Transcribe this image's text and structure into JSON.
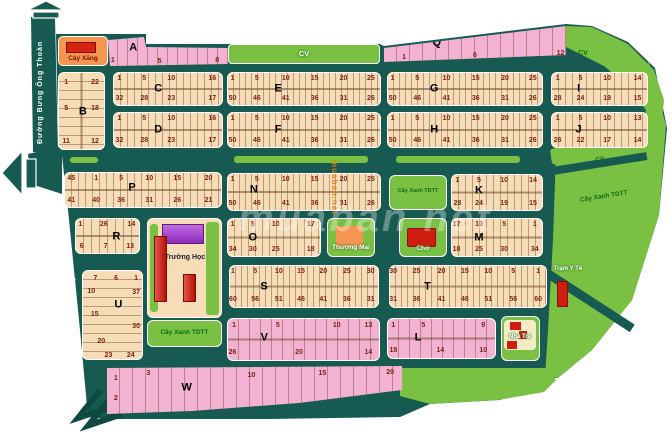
{
  "map_type": "land-plot subdivision map",
  "roads": {
    "name": "Đường Bưng Ông Thoàn"
  },
  "labels": {
    "park": "CV",
    "gas": "Cây Xăng",
    "school": "Trường Học",
    "commercial": "Thương Mại",
    "market": "Chợ",
    "health": "Trạm Y Tế",
    "kindergarten": "Nhà Trẻ",
    "green_tdtt": "Cây Xanh TDTT"
  },
  "watermark": {
    "main": "muaban net",
    "vertical": "muaban.net"
  },
  "colors": {
    "road": "#175a51",
    "cream_block": "#f7ddb7",
    "pink_block": "#f3b2d2",
    "green_area": "#7ac143",
    "gas_orange": "#f59550",
    "building_red": "#cf1d10",
    "building_purple": "#9a34c9",
    "number_text": "#7c1f12",
    "label_green_text": "#0e6b14"
  },
  "blocks": {
    "A": {
      "letter": "A",
      "bottom": [
        "1",
        "5",
        "8"
      ]
    },
    "B": {
      "letter": "B",
      "rows": [
        [
          "1",
          "22"
        ],
        [
          "5",
          "18"
        ],
        [
          "11",
          "12"
        ]
      ]
    },
    "C": {
      "letter": "C",
      "top": [
        "1",
        "5",
        "10",
        "16"
      ],
      "bottom": [
        "32",
        "28",
        "23",
        "17"
      ]
    },
    "D": {
      "letter": "D",
      "top": [
        "1",
        "5",
        "10",
        "16"
      ],
      "bottom": [
        "32",
        "28",
        "23",
        "17"
      ]
    },
    "E": {
      "letter": "E",
      "top": [
        "1",
        "5",
        "10",
        "15",
        "20",
        "25"
      ],
      "bottom": [
        "50",
        "46",
        "41",
        "36",
        "31",
        "26"
      ]
    },
    "F": {
      "letter": "F",
      "top": [
        "1",
        "5",
        "10",
        "15",
        "20",
        "25"
      ],
      "bottom": [
        "50",
        "46",
        "41",
        "36",
        "31",
        "26"
      ]
    },
    "G": {
      "letter": "G",
      "top": [
        "1",
        "5",
        "10",
        "15",
        "20",
        "25"
      ],
      "bottom": [
        "50",
        "46",
        "41",
        "36",
        "31",
        "26"
      ]
    },
    "H": {
      "letter": "H",
      "top": [
        "1",
        "5",
        "10",
        "15",
        "20",
        "25"
      ],
      "bottom": [
        "50",
        "46",
        "41",
        "36",
        "31",
        "26"
      ]
    },
    "I": {
      "letter": "I",
      "top": [
        "1",
        "5",
        "10",
        "14"
      ],
      "bottom": [
        "28",
        "24",
        "19",
        "15"
      ]
    },
    "J": {
      "letter": "J",
      "top": [
        "1",
        "5",
        "10",
        "13"
      ],
      "bottom": [
        "26",
        "22",
        "17",
        "14"
      ]
    },
    "K": {
      "letter": "K",
      "top": [
        "1",
        "5",
        "10",
        "14"
      ],
      "bottom": [
        "28",
        "24",
        "19",
        "15"
      ]
    },
    "L": {
      "letter": "L",
      "top": [
        "1",
        "5",
        "9"
      ],
      "bottom": [
        "18",
        "14",
        "10"
      ]
    },
    "M": {
      "letter": "M",
      "top": [
        "17",
        "10",
        "5",
        "1"
      ],
      "bottom": [
        "18",
        "25",
        "30",
        "34"
      ]
    },
    "N": {
      "letter": "N",
      "top": [
        "1",
        "5",
        "10",
        "15",
        "20",
        "25"
      ],
      "bottom": [
        "50",
        "46",
        "41",
        "36",
        "31",
        "26"
      ]
    },
    "O": {
      "letter": "O",
      "top": [
        "1",
        "5",
        "10",
        "17"
      ],
      "bottom": [
        "34",
        "30",
        "25",
        "18"
      ]
    },
    "P": {
      "letter": "P",
      "top": [
        "45",
        "1",
        "5",
        "10",
        "15",
        "20"
      ],
      "bottom": [
        "41",
        "40",
        "36",
        "31",
        "26",
        "21"
      ]
    },
    "Q": {
      "letter": "Q",
      "bottom": [
        "1",
        "6",
        "12"
      ]
    },
    "R": {
      "letter": "R",
      "top": [
        "1",
        "26",
        "14"
      ],
      "bottom": [
        "6",
        "7",
        "13"
      ]
    },
    "S": {
      "letter": "S",
      "top": [
        "1",
        "5",
        "10",
        "15",
        "20",
        "25",
        "30"
      ],
      "bottom": [
        "60",
        "56",
        "51",
        "46",
        "41",
        "36",
        "31"
      ]
    },
    "T": {
      "letter": "T",
      "top": [
        "30",
        "25",
        "20",
        "15",
        "10",
        "5",
        "1"
      ],
      "bottom": [
        "31",
        "36",
        "41",
        "46",
        "51",
        "56",
        "60"
      ]
    },
    "U": {
      "letter": "U",
      "nums": [
        "7",
        "6",
        "1",
        "10",
        "37",
        "15",
        "30",
        "20",
        "23",
        "24"
      ]
    },
    "V": {
      "letter": "V",
      "top": [
        "1",
        "5",
        "10",
        "13"
      ],
      "bottom": [
        "26",
        "20",
        "14"
      ]
    },
    "W": {
      "letter": "W",
      "nums": [
        "1",
        "3",
        "2",
        "10",
        "15",
        "20"
      ]
    }
  }
}
